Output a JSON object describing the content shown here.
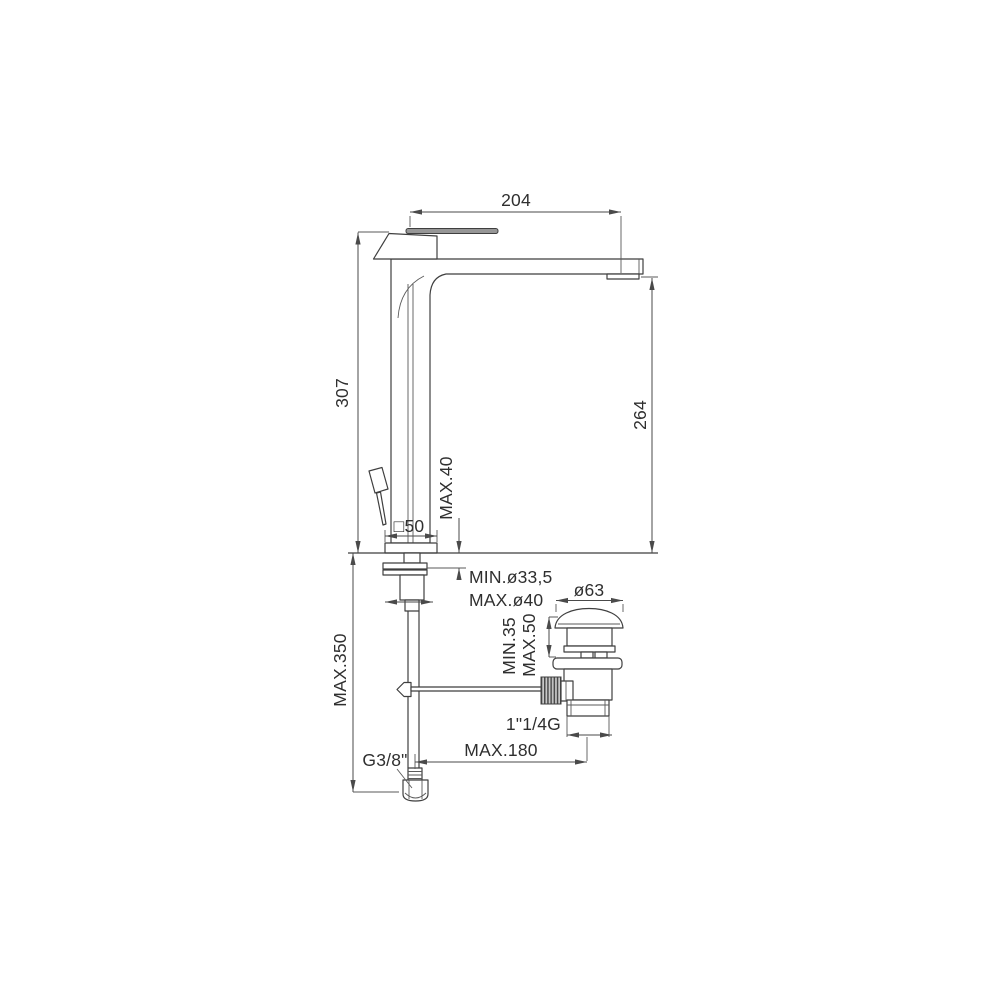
{
  "colors": {
    "ink": "#3f3f3f",
    "metal_gray": "#969696",
    "background": "#ffffff"
  },
  "labels": {
    "spout_reach": "204",
    "total_height": "307",
    "spout_outlet_height": "264",
    "deck_thickness_max": "MAX.40",
    "base_square": "□50",
    "hole_diameter_min": "MIN.ø33,5",
    "hole_diameter_max": "MAX.ø40",
    "waste_cap_diameter": "ø63",
    "waste_deck_min": "MIN.35",
    "waste_deck_max": "MAX.50",
    "waste_thread": "1\"1/4G",
    "waste_offset_max": "MAX.180",
    "hose_length_max": "MAX.350",
    "supply_thread": "G3/8\""
  }
}
